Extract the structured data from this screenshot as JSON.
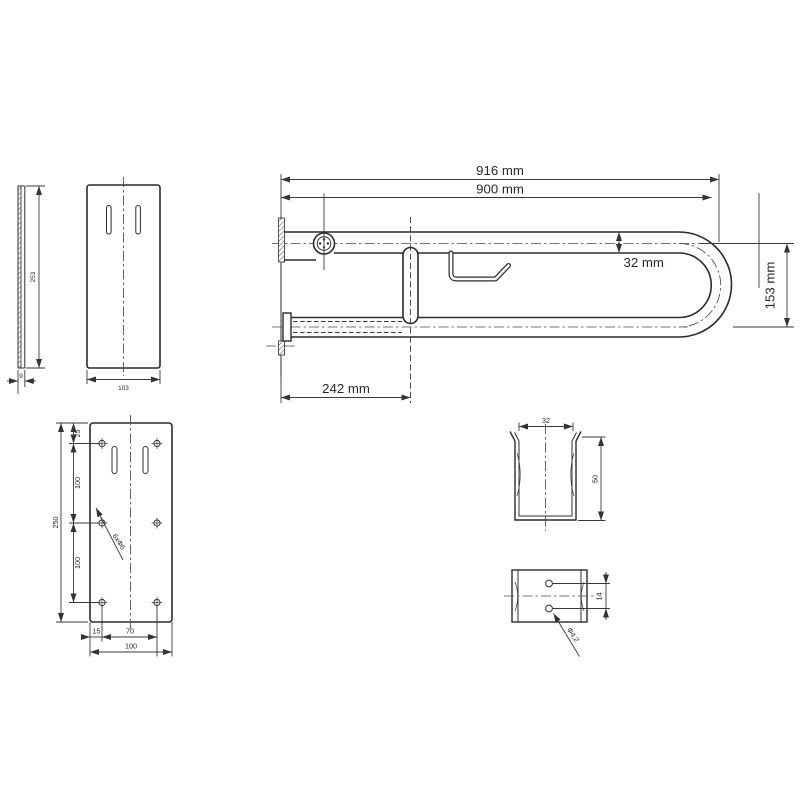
{
  "drawing": {
    "background_color": "#ffffff",
    "line_color": "#2b2b2b",
    "dim_text_color": "#1e2831",
    "views": {
      "main": {
        "overall_length": "916 mm",
        "mount_length": "900 mm",
        "tube_diameter": "32 mm",
        "tube_spacing": "153 mm",
        "pivot_offset": "242 mm"
      },
      "cover_side": {
        "height": "253",
        "thickness": "9"
      },
      "cover_front": {
        "width": "103"
      },
      "baseplate": {
        "top_margin": "25",
        "hole_gap_upper": "100",
        "hole_gap_lower": "100",
        "height": "250",
        "left_margin": "15",
        "hole_span": "70",
        "width": "100",
        "holes_label": "6xΦ6"
      },
      "clip_top": {
        "width": "32",
        "depth": "50"
      },
      "clip_front": {
        "hole_spacing": "14",
        "hole_diameter": "Φ4,2"
      }
    }
  }
}
